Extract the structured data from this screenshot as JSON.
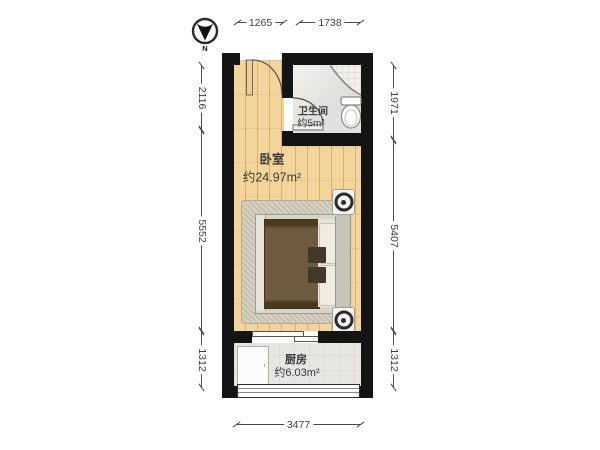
{
  "compass": {
    "label": "N"
  },
  "rooms": {
    "bedroom": {
      "name": "卧室",
      "area": "约24.97m²"
    },
    "bathroom": {
      "name": "卫生间",
      "area": "约5m²"
    },
    "kitchen": {
      "name": "厨房",
      "area": "约6.03m²"
    }
  },
  "dimensions": {
    "top": [
      "1265",
      "1738"
    ],
    "left": [
      "2116",
      "5552",
      "1312"
    ],
    "right": [
      "1971",
      "5407",
      "1312"
    ],
    "bottom": [
      "3477"
    ]
  },
  "colors": {
    "wall": "#141414",
    "wood_floor": "#f3d49a",
    "bath_tile": "#e9e7e3",
    "kitchen_tile": "#e7e6e2",
    "rug": "#ccc5b4",
    "bed": "#5d482a",
    "dimension_text": "#4a4a4a"
  }
}
